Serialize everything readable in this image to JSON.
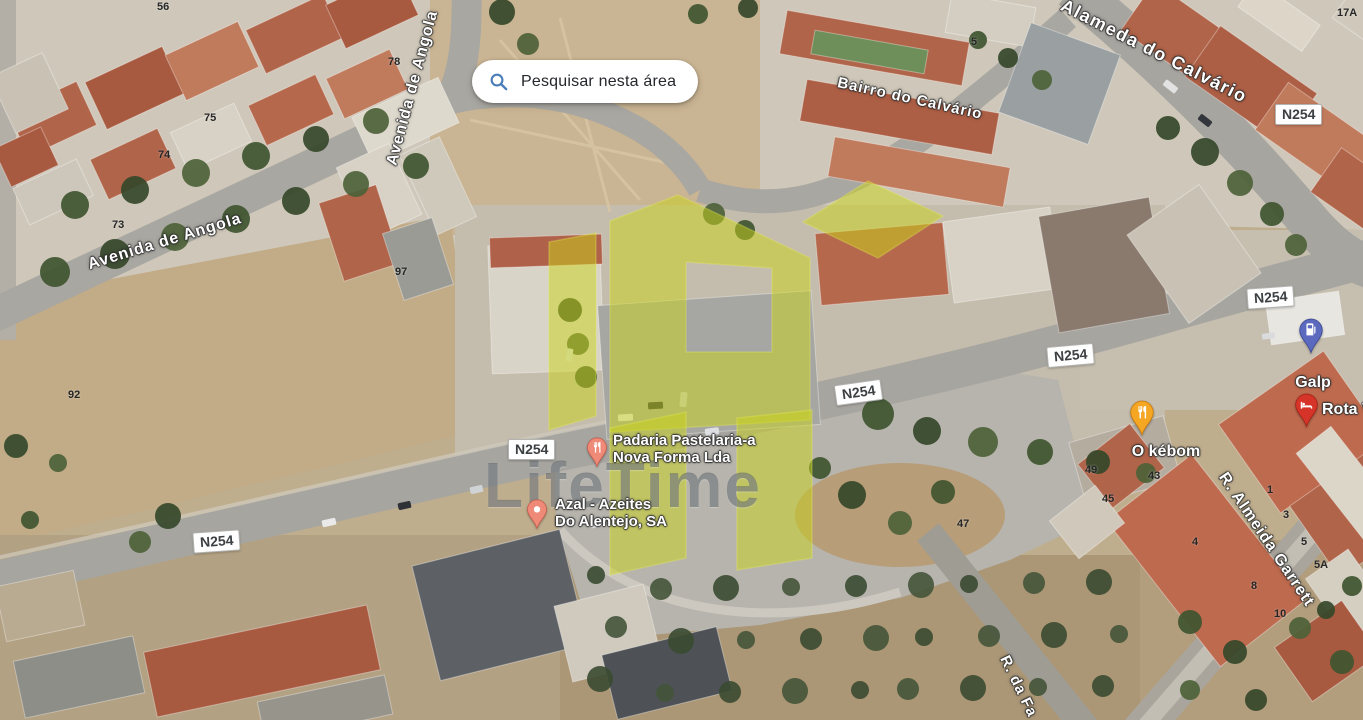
{
  "search_button": {
    "label": "Pesquisar nesta área",
    "accent_color": "#4a7cb8"
  },
  "road_shield": {
    "label": "N254"
  },
  "street_labels": {
    "avenida_de_angola": "Avenida de Angola",
    "bairro_do_calvario": "Bairro do Calvário",
    "alameda_do_calvario": "Alameda do Calvário",
    "rua_almeida_garrett": "R. Almeida Garrett",
    "rua_da_fa": "R. da Fa"
  },
  "pois": [
    {
      "name_line1": "Padaria Pastelaria-a",
      "name_line2": "Nova Forma Lda",
      "icon": "restaurant-pin",
      "pin_color": "#ee8a77",
      "pin_border": "#c9594a"
    },
    {
      "name_line1": "Azal - Azeites",
      "name_line2": "Do Alentejo, SA",
      "icon": "place-pin",
      "pin_color": "#ee8a77",
      "pin_border": "#c9594a"
    },
    {
      "name_line1": "O kébom",
      "icon": "restaurant-pin",
      "pin_color": "#f5a623",
      "pin_border": "#c87d12"
    },
    {
      "name_line1": "Galp",
      "icon": "gas-station-pin",
      "pin_color": "#5b6abf",
      "pin_border": "#3f4c96"
    },
    {
      "name_line1": "Rota V",
      "icon": "lodging-pin",
      "pin_color": "#d63429",
      "pin_border": "#a32318"
    }
  ],
  "house_numbers": [
    "56",
    "78",
    "75",
    "74",
    "73",
    "97",
    "92",
    "5",
    "17A",
    "49",
    "43",
    "45",
    "47",
    "4",
    "1",
    "3",
    "5",
    "5A",
    "8",
    "10"
  ],
  "watermark": {
    "text": "LifeTime",
    "logo_color": "#c9d318"
  }
}
